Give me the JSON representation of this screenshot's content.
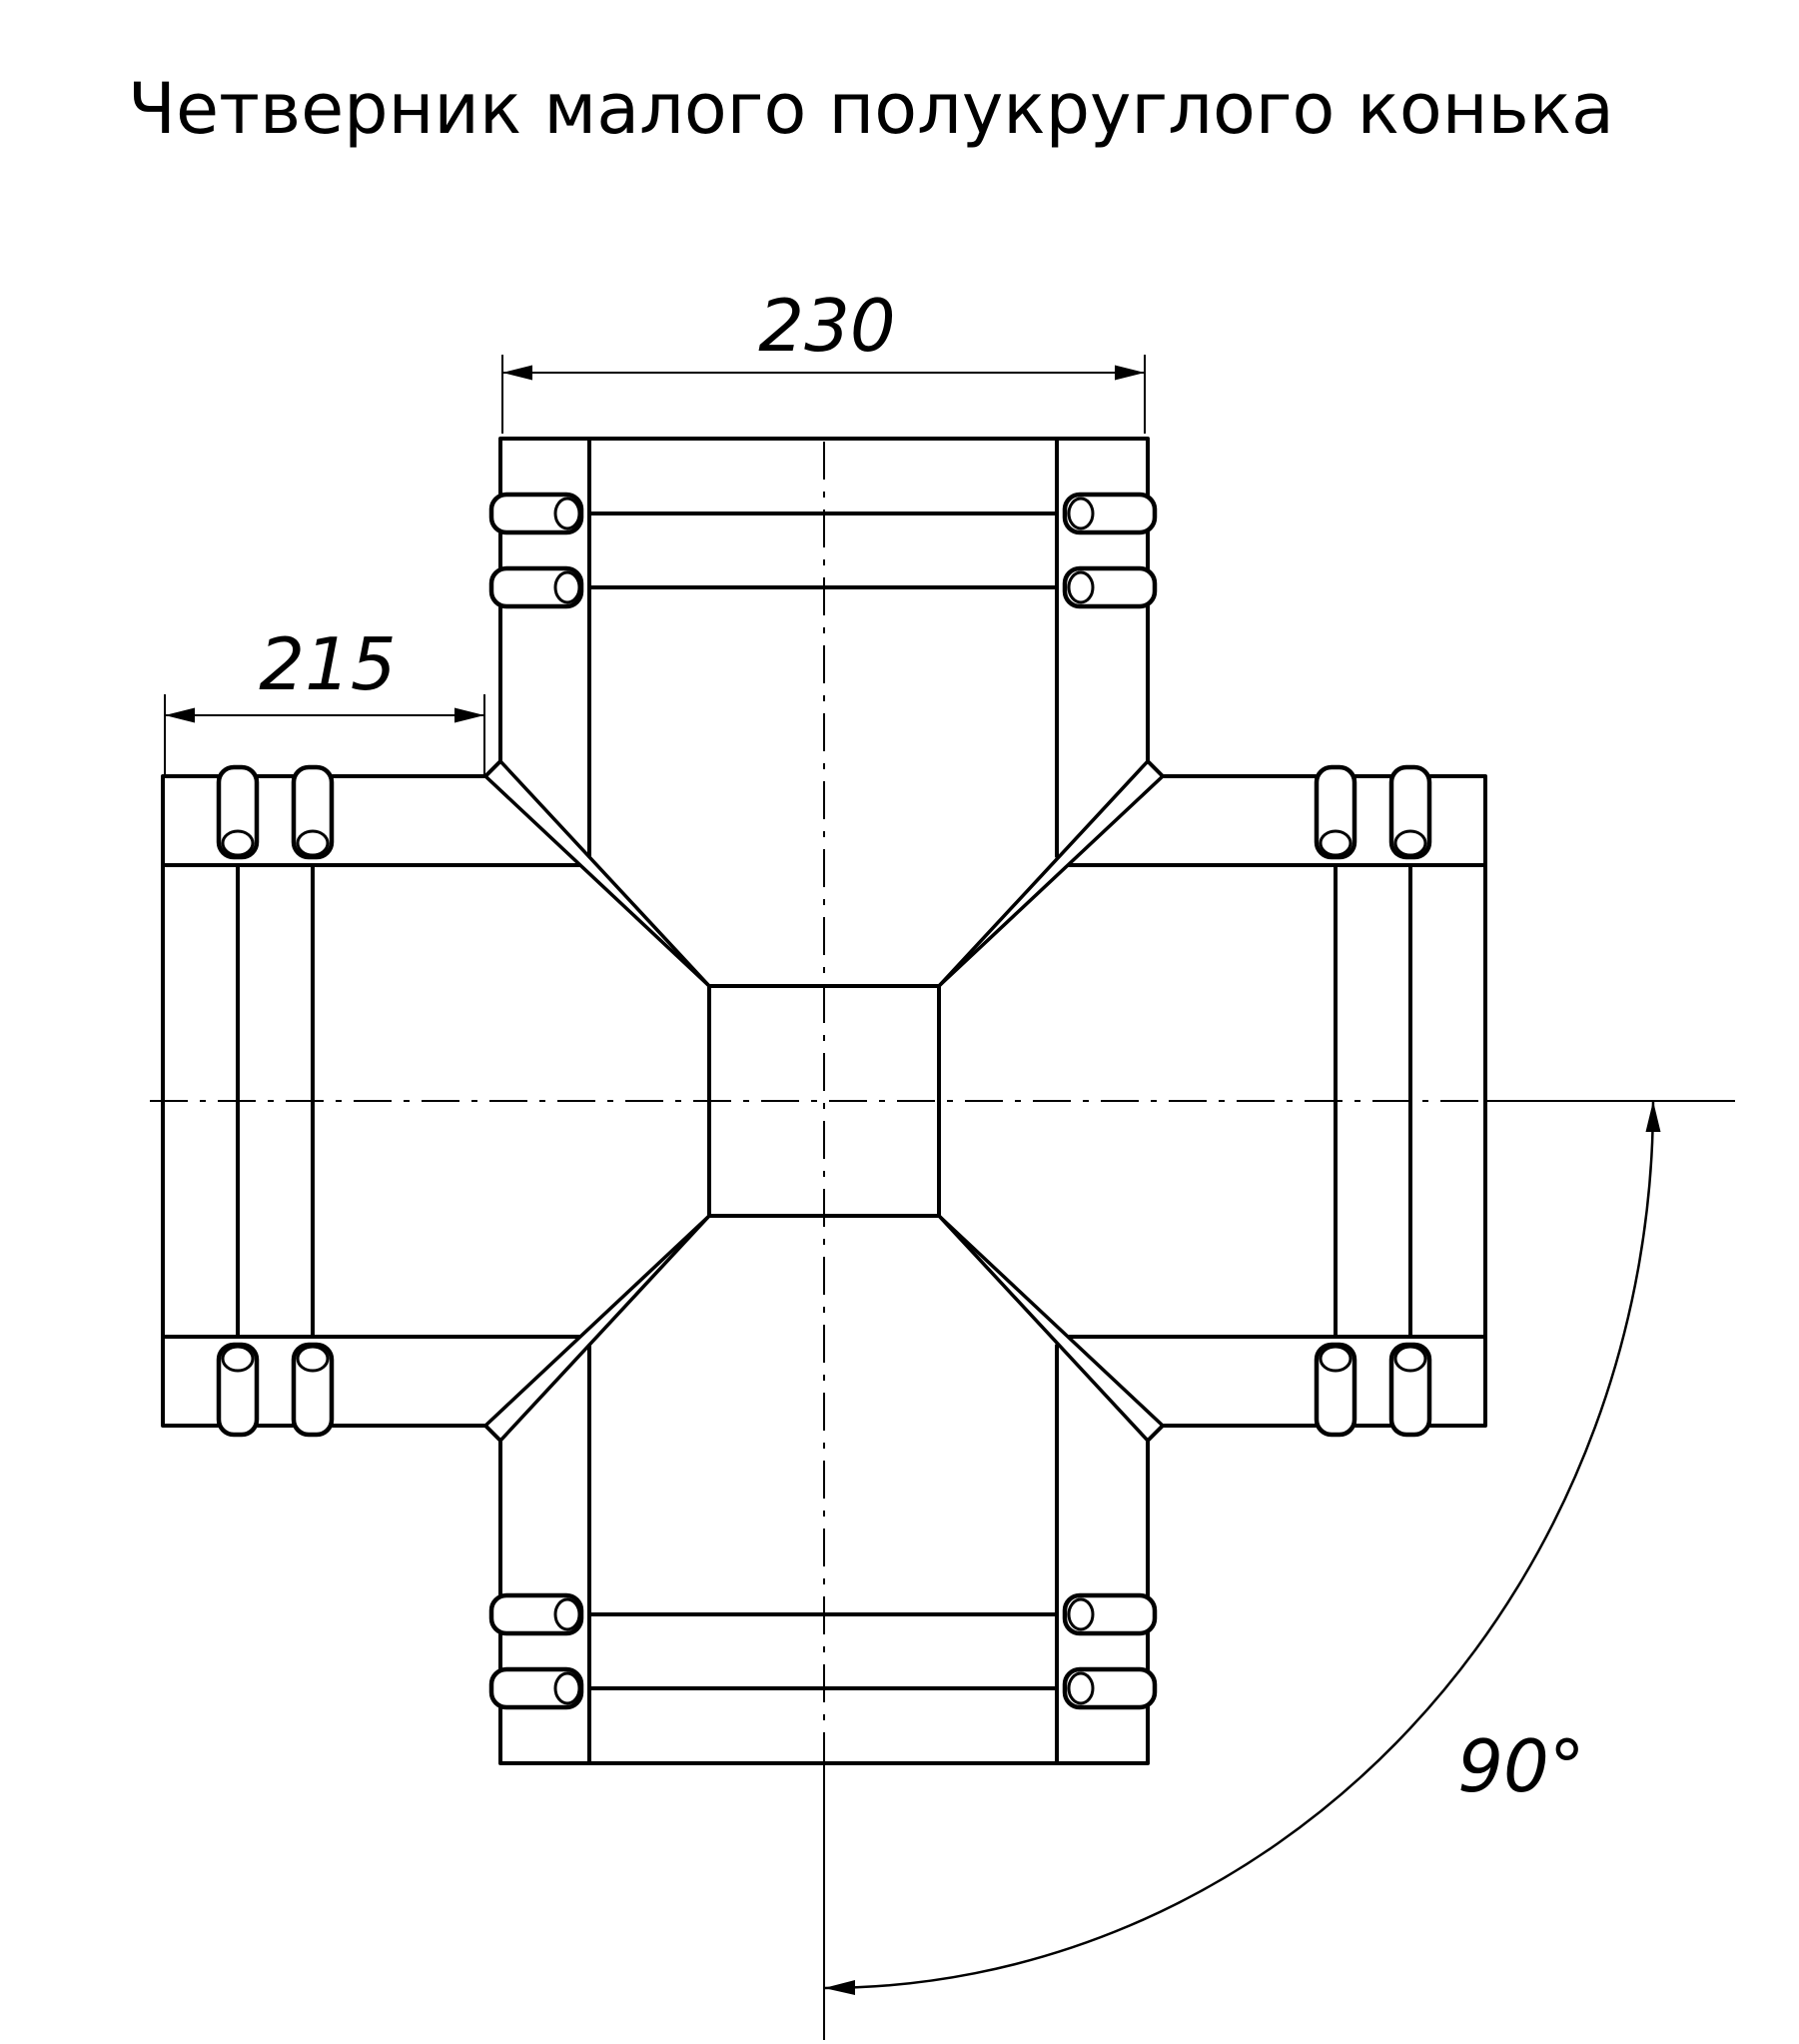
{
  "title": "Четверник малого полукруглого конька",
  "dimensions": {
    "top_width": "230",
    "left_length": "215",
    "angle": "90°"
  },
  "colors": {
    "line": "#000000",
    "background": "#ffffff",
    "text": "#000000"
  }
}
